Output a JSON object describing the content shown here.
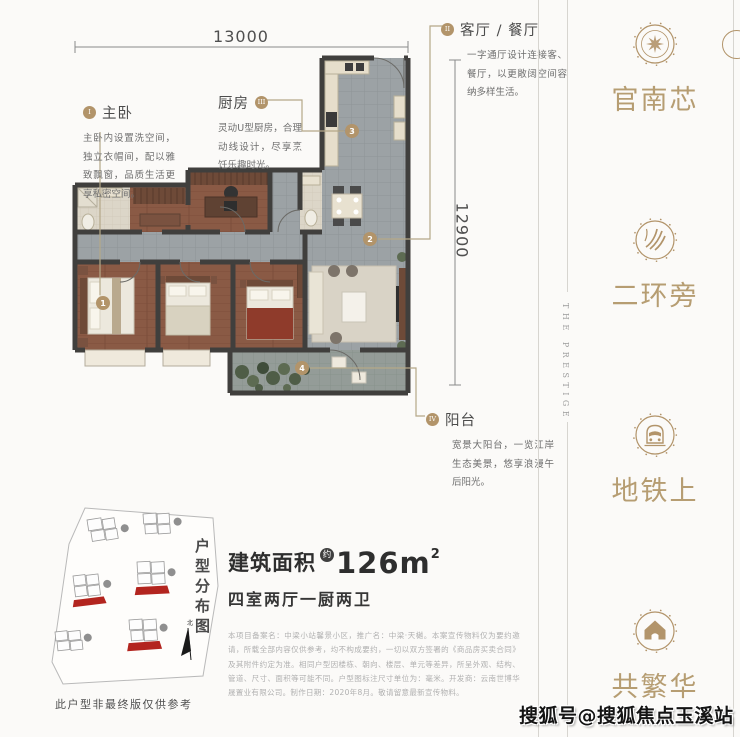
{
  "poster": {
    "dimensions": {
      "width": "13000",
      "height": "12900"
    },
    "annotations": {
      "master": {
        "numeral": "I",
        "title": "主卧",
        "body": "主卧内设置洗空间，独立衣帽间，配以雅致飘窗，品质生活更享私密空间。"
      },
      "kitchen": {
        "numeral": "III",
        "title": "厨房",
        "body": "灵动U型厨房，合理动线设计，尽享烹饪乐趣时光。"
      },
      "living": {
        "numeral": "II",
        "title": "客厅 / 餐厅",
        "body": "一字通厅设计连接客、餐厅，以更敞阔空间容纳多样生活。"
      },
      "balcony": {
        "numeral": "IV",
        "title": "阳台",
        "body": "宽景大阳台，一览江岸生态美景，悠享浪漫午后阳光。"
      }
    },
    "plan_markers": {
      "master": "1",
      "living": "2",
      "kitchen": "3",
      "balcony": "4"
    },
    "area": {
      "label": "建筑面积",
      "approx": "约",
      "value": "126m",
      "superscript": "2",
      "layout": "四室两厅一厨两卫"
    },
    "site_plan": {
      "title": "户型分布图",
      "north": "北",
      "caption": "此户型非最终版仅供参考"
    },
    "disclaimer": "本项目备案名：中梁小站馨景小区，推广名：中梁·天樾。本案宣传物料仅为要约邀请，所载全部内容仅供参考，均不构成要约，一切以双方签署的《商品房买卖合同》及其附件约定为准。相同户型因楼栋、朝向、楼层、单元等差异，所呈外观、结构、管道、尺寸、面积等可能不同。户型图标注尺寸单位为：毫米。开发商：云南世博华晟置业有限公司。制作日期：2020年8月。敬请留意最新宣传物料。",
    "sidebar": {
      "vertical_text": "THE PRESTIGE",
      "items": [
        {
          "label": "官南芯",
          "icon": "compass-icon"
        },
        {
          "label": "二环旁",
          "icon": "road-icon"
        },
        {
          "label": "地铁上",
          "icon": "train-icon"
        },
        {
          "label": "共繁华",
          "icon": "house-icon"
        }
      ]
    },
    "watermark": "搜狐号@搜狐焦点玉溪站",
    "colors": {
      "gold": "#b2946a",
      "wall": "#403f3d",
      "highlight_red": "#b3251f"
    }
  }
}
